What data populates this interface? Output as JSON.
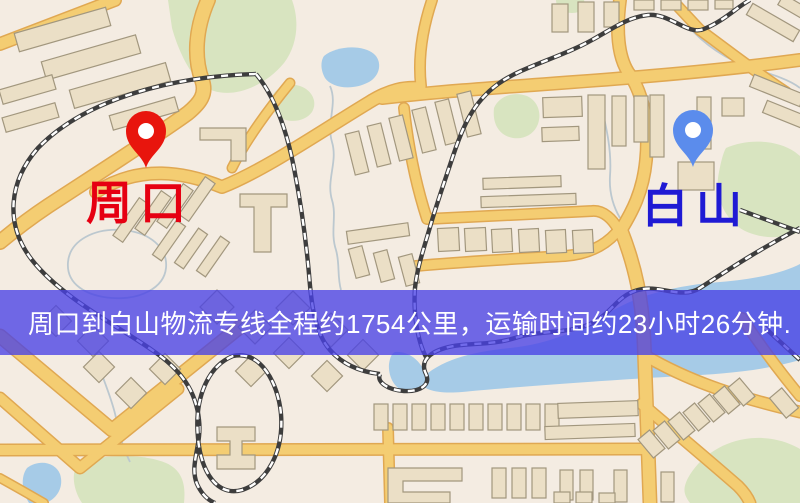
{
  "banner": {
    "text": "周口到白山物流专线全程约1754公里，运输时间约23小时26分钟.",
    "bg_color": "rgba(73,65,230,0.78)",
    "text_color": "#ffffff"
  },
  "markers": [
    {
      "id": "origin",
      "label": "周口",
      "pin_color": "#e8150d",
      "label_color": "#e60012"
    },
    {
      "id": "destination",
      "label": "白山",
      "pin_color": "#5b8cec",
      "label_color": "#1f1ad4"
    }
  ],
  "map": {
    "palette": {
      "land": "#f4ece2",
      "green": "#d8e4c0",
      "water": "#a6cbe7",
      "stream": "#bcc8cf",
      "road": "#f4cd72",
      "road_edge": "#e0a852",
      "building": "#ebdfc6",
      "building_edge": "#a2977e",
      "rail": "#3d3d3d"
    },
    "greens": [
      "M168,0 L292,0 C300,22 297,46 284,63 C266,85 236,98 214,91 C194,85 179,53 172,28 Z",
      "M272,98 C274,88 288,82 300,86 C312,90 318,102 312,112 C305,122 288,124 278,116 C271,110 270,104 272,98 Z",
      "M494,108 C499,96 514,91 527,96 C536,100 541,110 539,120 C537,132 526,140 513,138 C501,136 492,126 494,108 Z",
      "M726,148 C748,138 778,140 795,152 L800,156 L800,232 C779,241 751,238 736,225 C720,211 715,190 719,172 C721,162 723,153 726,148 Z",
      "M78,464 C100,454 142,453 166,463 C182,470 186,484 184,503 L82,503 C73,490 71,472 78,464 Z",
      "M688,478 C699,458 720,443 745,439 C770,435 790,443 800,449 L800,503 L690,503 C683,494 683,488 688,478 Z",
      "M556,0 L584,0 C586,7 582,13 572,13 C562,13 556,7 556,0 Z"
    ],
    "waters": [
      "M324,56 C336,46 362,44 374,54 C382,61 381,75 369,82 C352,91 332,88 325,78 C321,71 320,62 324,56 Z",
      "M420,380 C440,360 470,352 510,348 C550,344 580,330 610,312 C640,294 680,285 720,282 C758,279 785,272 800,264 L800,360 C762,371 722,374 682,376 C610,380 500,388 462,392 C437,394 421,390 420,380 Z",
      "M395,352 C407,351 419,359 424,371 C428,384 420,394 407,392 C395,390 388,377 389,364 C390,357 392,353 395,352 Z",
      "M27,468 C39,459 55,462 60,474 C64,486 58,498 46,503 L29,503 C21,490 21,476 27,468 Z"
    ],
    "streams": [
      "M330,86 C338,104 326,122 332,142 C338,162 326,180 332,200 C337,216 330,232 336,250 C340,264 337,276 341,290",
      "M688,26 C704,44 726,60 752,68 C774,75 790,80 800,88",
      "M96,356 C102,378 112,398 116,418 C120,438 124,450 130,462",
      "M600,100 C606,126 612,150 610,176 C609,192 613,206 620,218",
      "M68,262 C70,240 95,228 122,230 C150,232 168,248 166,268 C164,288 140,300 112,298 C86,296 66,284 68,262 Z"
    ],
    "roads": [
      {
        "d": "M0,44 L115,0",
        "w": 11
      },
      {
        "d": "M208,0 C195,30 194,58 202,80 C207,94 200,103 188,113 C158,135 100,172 48,206 C30,218 12,232 0,242",
        "w": 13
      },
      {
        "d": "M96,192 C140,164 185,172 222,187 C265,170 320,132 368,103 C390,89 405,87 420,88",
        "w": 11
      },
      {
        "d": "M290,83 C268,110 246,140 232,168",
        "w": 8
      },
      {
        "d": "M382,98 C470,88 560,84 650,76 C720,70 770,64 800,60",
        "w": 11
      },
      {
        "d": "M432,0 C422,30 418,60 421,86",
        "w": 9
      },
      {
        "d": "M620,0 C616,30 618,56 628,72 C645,95 649,130 646,160 C643,192 632,212 621,230",
        "w": 11
      },
      {
        "d": "M621,230 C636,268 642,300 644,340 C646,390 648,450 650,503",
        "w": 12
      },
      {
        "d": "M404,108 C408,145 416,185 427,219 L592,211 C604,210 613,220 618,229",
        "w": 9
      },
      {
        "d": "M416,266 C470,261 530,258 565,256 C590,254 606,244 616,233",
        "w": 9
      },
      {
        "d": "M0,336 L112,430 L240,327",
        "w": 12
      },
      {
        "d": "M0,398 L80,468 L178,389",
        "w": 10
      },
      {
        "d": "M0,450 L643,449",
        "w": 10
      },
      {
        "d": "M388,428 L390,503",
        "w": 9
      },
      {
        "d": "M646,356 C690,382 740,398 800,412",
        "w": 10
      },
      {
        "d": "M642,404 C670,428 706,458 738,486 C744,492 748,498 750,503",
        "w": 10
      },
      {
        "d": "M742,318 C760,345 780,372 800,396",
        "w": 9
      },
      {
        "d": "M700,30 C730,52 758,74 786,92",
        "w": 9
      },
      {
        "d": "M672,0 L700,30",
        "w": 9
      },
      {
        "d": "M0,478 C18,488 32,496 44,503",
        "w": 7
      }
    ],
    "railways": [
      "M256,74 C175,76 86,98 38,148 C9,181 4,224 32,260 C62,298 118,326 152,350 C180,369 196,390 199,420 C202,446 189,464 197,484 C202,495 208,500 215,503",
      "M256,74 C276,98 287,132 294,168 C301,204 306,240 309,274 C311,300 314,332 330,350 C344,366 362,372 380,374",
      "M233,356 C208,366 194,398 198,438 C201,472 217,497 242,490 C267,482 284,452 281,414 C278,382 260,350 233,356 Z",
      "M800,228 C758,250 728,270 700,288 C681,300 660,284 638,290 C616,296 612,314 590,324 C568,334 540,330 515,338 C490,346 465,342 445,348 C428,353 420,362 426,374 C431,385 420,392 404,391 C388,390 376,382 380,374",
      "M750,0 C737,7 724,21 704,29 C688,36 670,13 648,15 C628,17 612,29 592,40 C562,57 521,67 498,84 C472,103 462,129 453,156 C444,183 436,206 430,227 C424,248 417,268 415,288 C413,315 418,342 426,357",
      "M740,210 L800,232",
      "M763,326 L800,360"
    ],
    "buildings": [
      [
        15,
        20,
        95,
        19,
        -16
      ],
      [
        42,
        48,
        98,
        19,
        -16
      ],
      [
        70,
        76,
        100,
        19,
        -16
      ],
      [
        0,
        82,
        55,
        15,
        -16
      ],
      [
        3,
        110,
        55,
        15,
        -16
      ],
      [
        110,
        106,
        68,
        15,
        -16
      ],
      [
        552,
        4,
        16,
        28,
        0
      ],
      [
        578,
        2,
        16,
        30,
        0
      ],
      [
        604,
        2,
        15,
        25,
        0
      ],
      [
        634,
        0,
        20,
        10,
        0
      ],
      [
        661,
        0,
        20,
        10,
        0
      ],
      [
        688,
        0,
        20,
        10,
        0
      ],
      [
        715,
        0,
        18,
        9,
        0
      ],
      [
        746,
        16,
        54,
        13,
        30
      ],
      [
        778,
        4,
        42,
        12,
        30
      ],
      [
        750,
        84,
        54,
        13,
        22
      ],
      [
        763,
        110,
        54,
        13,
        22
      ],
      [
        350,
        132,
        14,
        42,
        -14
      ],
      [
        372,
        124,
        14,
        42,
        -14
      ],
      [
        394,
        116,
        14,
        44,
        -14
      ],
      [
        417,
        108,
        14,
        44,
        -14
      ],
      [
        440,
        100,
        14,
        44,
        -14
      ],
      [
        462,
        92,
        14,
        44,
        -14
      ],
      [
        543,
        97,
        39,
        20,
        -2
      ],
      [
        542,
        127,
        37,
        14,
        -2
      ],
      [
        588,
        95,
        17,
        74,
        0
      ],
      [
        612,
        96,
        14,
        50,
        0
      ],
      [
        634,
        96,
        14,
        46,
        0
      ],
      [
        650,
        95,
        14,
        62,
        0
      ],
      [
        697,
        97,
        14,
        52,
        0
      ],
      [
        722,
        98,
        22,
        18,
        0
      ],
      [
        678,
        162,
        36,
        28,
        0
      ],
      [
        483,
        177,
        78,
        11,
        -2
      ],
      [
        481,
        195,
        95,
        11,
        -2
      ],
      [
        438,
        228,
        21,
        23,
        -3
      ],
      [
        465,
        228,
        21,
        23,
        -3
      ],
      [
        492,
        229,
        20,
        23,
        -3
      ],
      [
        519,
        229,
        20,
        23,
        -3
      ],
      [
        546,
        230,
        20,
        23,
        -3
      ],
      [
        573,
        230,
        20,
        23,
        -3
      ],
      [
        108,
        214,
        46,
        12,
        -55
      ],
      [
        130,
        207,
        46,
        12,
        -55
      ],
      [
        152,
        200,
        46,
        12,
        -55
      ],
      [
        174,
        193,
        46,
        12,
        -55
      ],
      [
        148,
        235,
        42,
        11,
        -55
      ],
      [
        170,
        243,
        42,
        11,
        -55
      ],
      [
        192,
        251,
        42,
        11,
        -55
      ],
      [
        347,
        227,
        62,
        13,
        -8
      ],
      [
        352,
        247,
        14,
        30,
        -15
      ],
      [
        377,
        251,
        14,
        30,
        -15
      ],
      [
        402,
        255,
        14,
        30,
        -15
      ],
      [
        205,
        295,
        24,
        24,
        45
      ],
      [
        243,
        315,
        24,
        24,
        45
      ],
      [
        281,
        296,
        24,
        24,
        45
      ],
      [
        319,
        318,
        24,
        24,
        45
      ],
      [
        240,
        360,
        22,
        22,
        45
      ],
      [
        278,
        342,
        22,
        22,
        45
      ],
      [
        316,
        365,
        22,
        22,
        45
      ],
      [
        352,
        344,
        22,
        22,
        45
      ],
      [
        88,
        356,
        22,
        22,
        45
      ],
      [
        120,
        382,
        22,
        22,
        45
      ],
      [
        154,
        358,
        22,
        22,
        45
      ],
      [
        45,
        310,
        22,
        22,
        45
      ],
      [
        82,
        330,
        22,
        22,
        45
      ],
      [
        374,
        404,
        14,
        26,
        0
      ],
      [
        393,
        404,
        14,
        26,
        0
      ],
      [
        412,
        404,
        14,
        26,
        0
      ],
      [
        431,
        404,
        14,
        26,
        0
      ],
      [
        450,
        404,
        14,
        26,
        0
      ],
      [
        469,
        404,
        14,
        26,
        0
      ],
      [
        488,
        404,
        14,
        26,
        0
      ],
      [
        507,
        404,
        14,
        26,
        0
      ],
      [
        526,
        404,
        14,
        26,
        0
      ],
      [
        545,
        404,
        14,
        26,
        0
      ],
      [
        558,
        402,
        80,
        15,
        -2
      ],
      [
        545,
        425,
        90,
        13,
        -2
      ],
      [
        492,
        468,
        14,
        30,
        0
      ],
      [
        512,
        468,
        14,
        30,
        0
      ],
      [
        532,
        468,
        14,
        30,
        0
      ],
      [
        560,
        470,
        13,
        30,
        0
      ],
      [
        580,
        470,
        13,
        30,
        0
      ],
      [
        614,
        470,
        13,
        32,
        0
      ],
      [
        661,
        472,
        13,
        30,
        0
      ],
      [
        554,
        492,
        16,
        11,
        0
      ],
      [
        576,
        492,
        16,
        11,
        0
      ],
      [
        599,
        493,
        16,
        10,
        0
      ],
      [
        644,
        432,
        15,
        24,
        -40
      ],
      [
        659,
        423,
        15,
        24,
        -40
      ],
      [
        674,
        414,
        15,
        24,
        -40
      ],
      [
        689,
        405,
        15,
        24,
        -40
      ],
      [
        704,
        396,
        15,
        24,
        -40
      ],
      [
        719,
        388,
        15,
        24,
        -40
      ],
      [
        734,
        380,
        15,
        24,
        -40
      ],
      [
        776,
        390,
        16,
        26,
        -40
      ]
    ],
    "building_paths": [
      "M200,128 h46 v33 h-15 v-21 h-31 Z",
      "M240,194 h47 v13 h-16 v45 h-17 v-45 h-14 Z",
      "M217,427 h38 v14 h-13 v14 h13 v14 h-38 v-14 h13 v-14 h-13 Z",
      "M388,468 h74 v13 h-59 v11 h47 v11 h-62 Z"
    ]
  }
}
